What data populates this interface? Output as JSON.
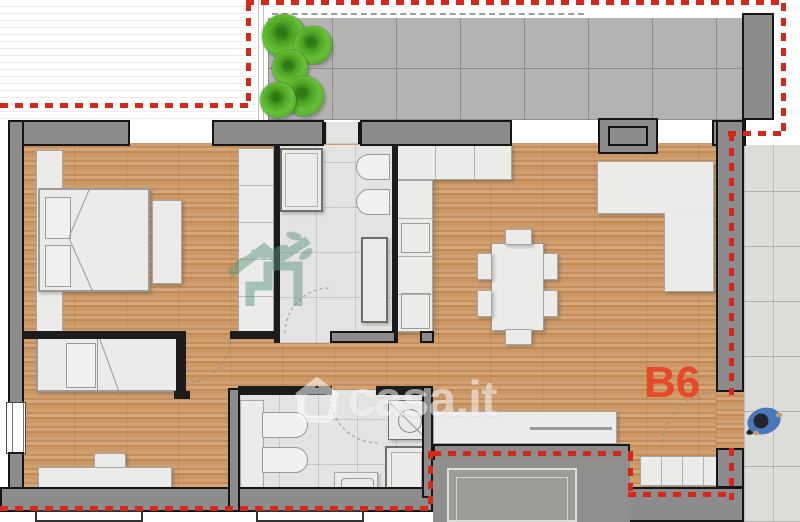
{
  "plan": {
    "unit_label": "B6",
    "watermark_text": "casa.it"
  },
  "icons": {
    "watermark_logo": "casa-house-icon",
    "builder_logo": "green-leaves-house-icon",
    "person": "person-top-view-icon",
    "plants": "shrub-icon"
  },
  "colors": {
    "boundary": "#d6281a",
    "unit-label": "#e8492a",
    "wall": "#8c8c8c",
    "wood": "#c9996a",
    "terrace-tile": "#b4b3b1",
    "balcony-tile": "#dcdcd9",
    "bath-tile": "#e3e3e1",
    "furniture": "#ebebe9",
    "plant": "#5cb52e",
    "person": "#4a77bb",
    "logo-green": "#5d9481"
  }
}
